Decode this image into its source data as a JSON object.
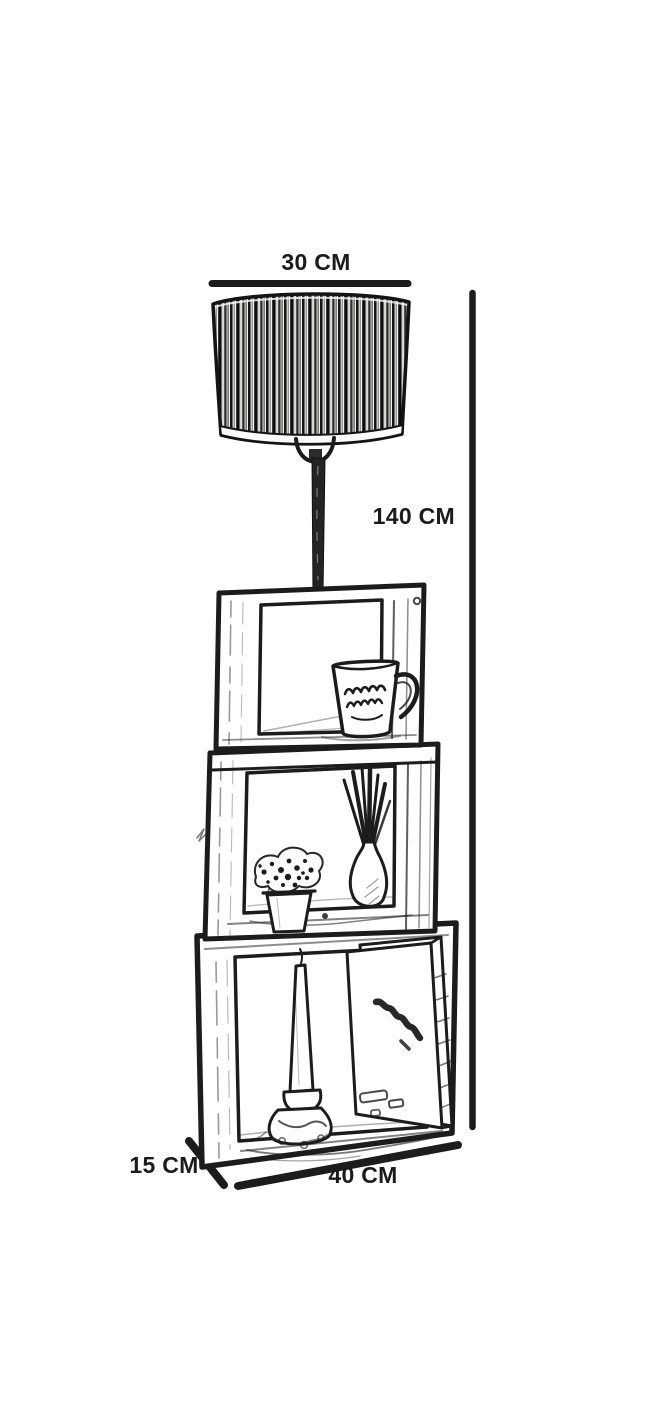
{
  "diagram": {
    "subject": "Floor lamp with three stacked wooden crate shelves - dimension drawing",
    "background_color": "#ffffff",
    "ink_color": "#1c1c1c",
    "dimensions": {
      "top_width": {
        "label": "30 CM",
        "value_cm": 30
      },
      "height": {
        "label": "140 CM",
        "value_cm": 140
      },
      "depth": {
        "label": "15 CM",
        "value_cm": 15
      },
      "bottom_width": {
        "label": "40 CM",
        "value_cm": 40
      }
    },
    "parts": [
      "striped drum lamp shade",
      "lamp pole with harp fitting",
      "top crate shelf holding a coffee mug",
      "middle crate shelf holding potted flowers and a reed diffuser vase",
      "bottom crate shelf holding a candlestick and a leaning magazine"
    ]
  }
}
